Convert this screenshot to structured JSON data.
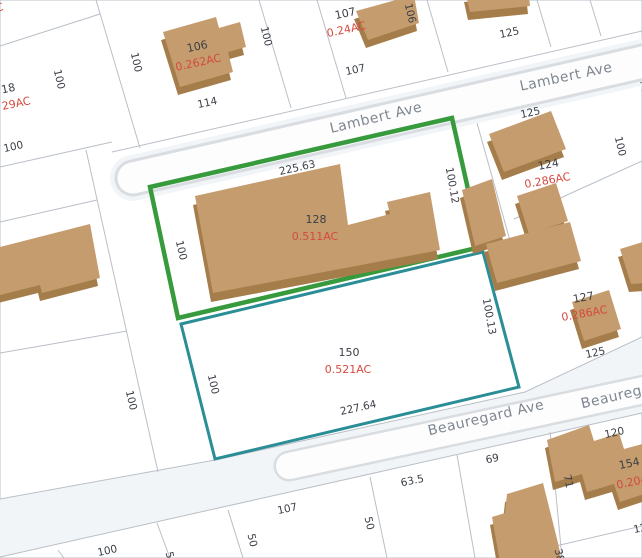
{
  "map": {
    "kind": "parcel-map",
    "colors": {
      "background": "#f2f5f8",
      "parcel_fill": "#ffffff",
      "lot_line": "#b9bfc7",
      "road_casing": "#d9dce0",
      "building_fill": "#c59c6e",
      "building_shadow": "#a57d4b",
      "highlight_green": "#379a3c",
      "highlight_teal": "#2b8e96",
      "number_text": "#3a3e46",
      "acreage_text": "#d44a40",
      "street_text": "#7e868f"
    },
    "streets": {
      "lambert": "Lambert Ave",
      "beauregard": "Beauregard Ave",
      "edge_fragment": "M"
    },
    "parcels": {
      "p18": {
        "number": "18",
        "acreage": "29AC"
      },
      "p106": {
        "number": "106",
        "acreage": "0.262AC"
      },
      "p107": {
        "number": "107",
        "acreage": "0.24AC"
      },
      "p124": {
        "number": "124",
        "acreage": "0.286AC"
      },
      "p127": {
        "number": "127",
        "acreage": "0.286AC"
      },
      "p128": {
        "number": "128",
        "acreage": "0.511AC",
        "highlight": "green"
      },
      "p150": {
        "number": "150",
        "acreage": "0.521AC",
        "highlight": "teal"
      },
      "p154": {
        "number": "154",
        "acreage": "0.204AC"
      },
      "corner_fragment": "C"
    },
    "dims": {
      "d100": "100",
      "d106": "106",
      "d107": "107",
      "d114": "114",
      "d125": "125",
      "d120": "120",
      "d69": "69",
      "d71": "71",
      "d63_5": "63.5",
      "d50": "50",
      "d38": "38",
      "d225_63": "225.63",
      "d227_64": "227.64",
      "d100_12": "100.12",
      "d100_13": "100.13"
    }
  }
}
